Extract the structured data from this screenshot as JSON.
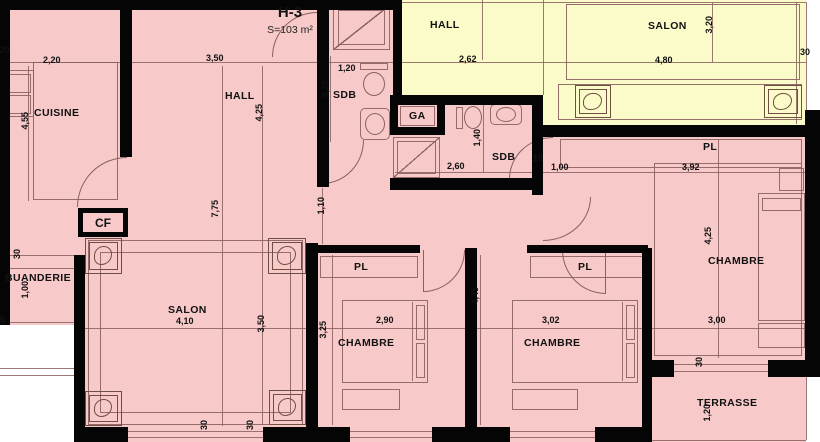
{
  "plan": {
    "title": "H-3",
    "area": "S=103 m²",
    "colors": {
      "room_pink": "#f7c9c9",
      "room_yellow": "#fbfbca",
      "wall_black": "#050505",
      "thin_line": "#8a6060"
    },
    "room_labels": [
      {
        "t": "CUISINE",
        "x": 34,
        "y": 107
      },
      {
        "t": "HALL",
        "x": 225,
        "y": 90
      },
      {
        "t": "SDB",
        "x": 333,
        "y": 89
      },
      {
        "t": "GA",
        "x": 409,
        "y": 110
      },
      {
        "t": "HALL",
        "x": 430,
        "y": 19
      },
      {
        "t": "SALON",
        "x": 648,
        "y": 20
      },
      {
        "t": "SDB",
        "x": 492,
        "y": 151
      },
      {
        "t": "PL",
        "x": 703,
        "y": 141
      },
      {
        "t": "CHAMBRE",
        "x": 708,
        "y": 255
      },
      {
        "t": "PL",
        "x": 354,
        "y": 261
      },
      {
        "t": "PL",
        "x": 578,
        "y": 261
      },
      {
        "t": "CHAMBRE",
        "x": 338,
        "y": 337
      },
      {
        "t": "CHAMBRE",
        "x": 524,
        "y": 337
      },
      {
        "t": "SALON",
        "x": 168,
        "y": 304
      },
      {
        "t": "BUANDERIE",
        "x": 5,
        "y": 272
      },
      {
        "t": "TERRASSE",
        "x": 697,
        "y": 397
      }
    ],
    "dim_labels": [
      {
        "t": "20",
        "x": 0,
        "y": 45
      },
      {
        "t": "2,20",
        "x": 43,
        "y": 55
      },
      {
        "t": "3,50",
        "x": 206,
        "y": 53
      },
      {
        "t": "1,20",
        "x": 338,
        "y": 63
      },
      {
        "t": "2,62",
        "x": 459,
        "y": 54
      },
      {
        "t": "4,80",
        "x": 655,
        "y": 55
      },
      {
        "t": "30",
        "x": 800,
        "y": 47
      },
      {
        "t": "2,60",
        "x": 447,
        "y": 161
      },
      {
        "t": "10",
        "x": 533,
        "y": 153
      },
      {
        "t": "1,00",
        "x": 551,
        "y": 162
      },
      {
        "t": "3,92",
        "x": 682,
        "y": 162
      },
      {
        "t": "4,10",
        "x": 176,
        "y": 316
      },
      {
        "t": "2,90",
        "x": 376,
        "y": 315
      },
      {
        "t": "3,02",
        "x": 542,
        "y": 315
      },
      {
        "t": "3,00",
        "x": 708,
        "y": 315
      },
      {
        "t": "5",
        "x": 0,
        "y": 315
      },
      {
        "t": "4,55",
        "x": 20,
        "y": 112,
        "v": true
      },
      {
        "t": "4,25",
        "x": 254,
        "y": 104,
        "v": true
      },
      {
        "t": "3,20",
        "x": 320,
        "y": 80,
        "v": true
      },
      {
        "t": "3,20",
        "x": 704,
        "y": 16,
        "v": true
      },
      {
        "t": "1,40",
        "x": 472,
        "y": 129,
        "v": true
      },
      {
        "t": "7,75",
        "x": 210,
        "y": 200,
        "v": true
      },
      {
        "t": "1,10",
        "x": 316,
        "y": 197,
        "v": true
      },
      {
        "t": "4,25",
        "x": 703,
        "y": 227,
        "v": true
      },
      {
        "t": "3,25",
        "x": 318,
        "y": 321,
        "v": true
      },
      {
        "t": "4,45",
        "x": 470,
        "y": 287,
        "v": true
      },
      {
        "t": "3,50",
        "x": 256,
        "y": 315,
        "v": true
      },
      {
        "t": "30",
        "x": 12,
        "y": 249,
        "v": true
      },
      {
        "t": "1,00",
        "x": 20,
        "y": 281,
        "v": true
      },
      {
        "t": "30",
        "x": 694,
        "y": 357,
        "v": true
      },
      {
        "t": "1,20",
        "x": 702,
        "y": 404,
        "v": true
      },
      {
        "t": "30",
        "x": 199,
        "y": 420,
        "v": true
      },
      {
        "t": "30",
        "x": 245,
        "y": 420,
        "v": true
      }
    ],
    "cf_label": "CF"
  }
}
